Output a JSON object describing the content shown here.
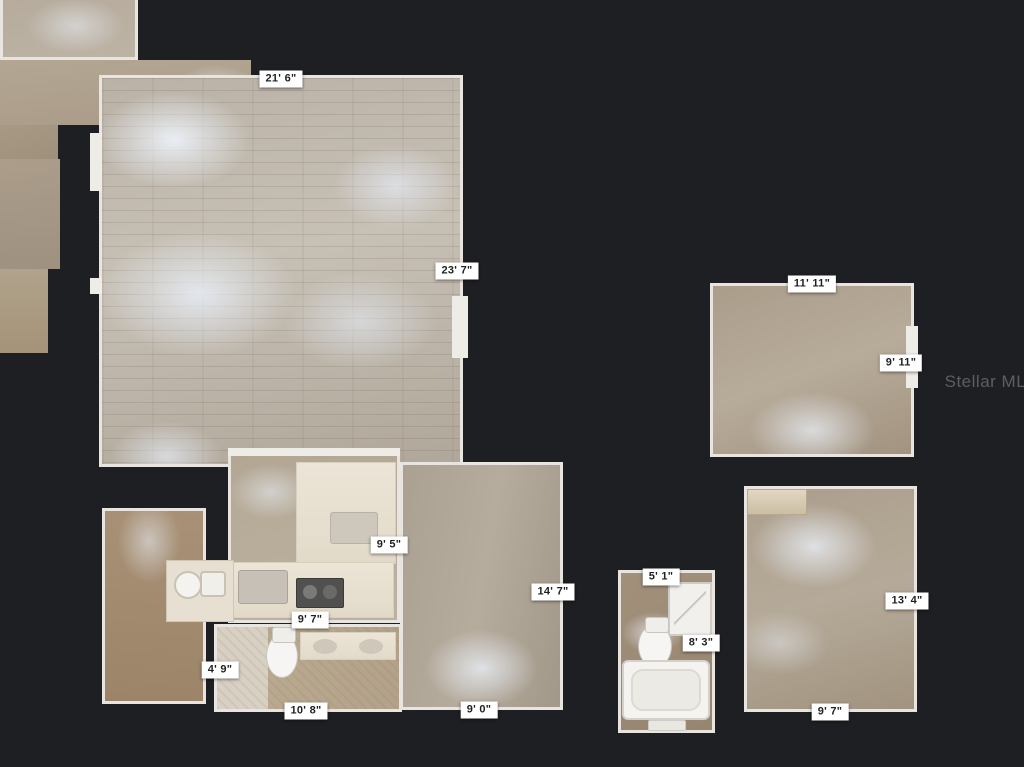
{
  "background_color": "#1e1f22",
  "wall_color": "#e8e5e0",
  "watermark": {
    "text": "Stellar MLS"
  },
  "labels": {
    "living_width": "21' 6\"",
    "living_depth": "23' 7\"",
    "dining_width": "11' 11\"",
    "dining_depth": "9' 11\"",
    "kitchen_depth": "9' 5\"",
    "kitchen_width": "9' 7\"",
    "bedroom_mid_depth": "14' 7\"",
    "bedroom_mid_width": "9' 0\"",
    "bath_small_width": "5' 1\"",
    "bath_small_depth": "8' 3\"",
    "bedroom_right_depth": "13' 4\"",
    "bedroom_right_width": "9' 7\"",
    "hall_width": "4' 9\"",
    "bath_left_width": "10' 8\""
  }
}
